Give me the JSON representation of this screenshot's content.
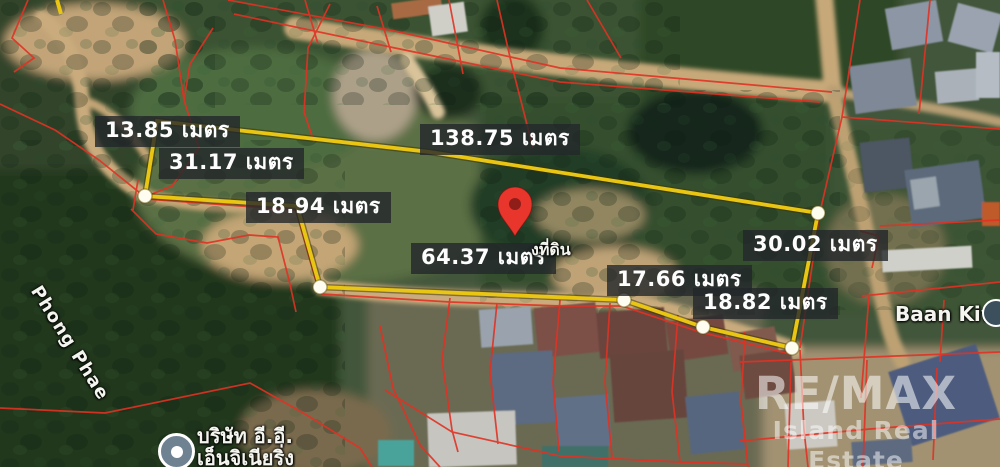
{
  "page": {
    "width": 1000,
    "height": 467,
    "kind": "annotated satellite map of land plot"
  },
  "map": {
    "measurements": [
      {
        "id": "west-edge",
        "text": "13.85 เมตร"
      },
      {
        "id": "northwest-edge",
        "text": "31.17 เมตร"
      },
      {
        "id": "north-edge",
        "text": "138.75 เมตร"
      },
      {
        "id": "west-inner-edge",
        "text": "18.94 เมตร"
      },
      {
        "id": "south-edge",
        "text": "64.37 เมตร"
      },
      {
        "id": "southeast-edge-1",
        "text": "17.66 เมตร"
      },
      {
        "id": "east-edge",
        "text": "30.02 เมตร"
      },
      {
        "id": "southeast-edge-2",
        "text": "18.82 เมตร"
      }
    ],
    "place_labels": {
      "road": "Phong Phae",
      "village": "Baan Kiwi",
      "company_line1": "บริษัท อี.อี.",
      "company_line2": "เอ็นจิเนียริ่ง",
      "land_text_partial": "งที่ดิน"
    },
    "watermark": {
      "brand": "RE/MAX",
      "subtitle": "Island Real Estate"
    },
    "colors": {
      "boundary_yellow": "#e9c514",
      "parcel_red": "#e03224",
      "pin_red": "#e8362c",
      "label_bg": "rgba(35,39,42,0.8)"
    }
  }
}
